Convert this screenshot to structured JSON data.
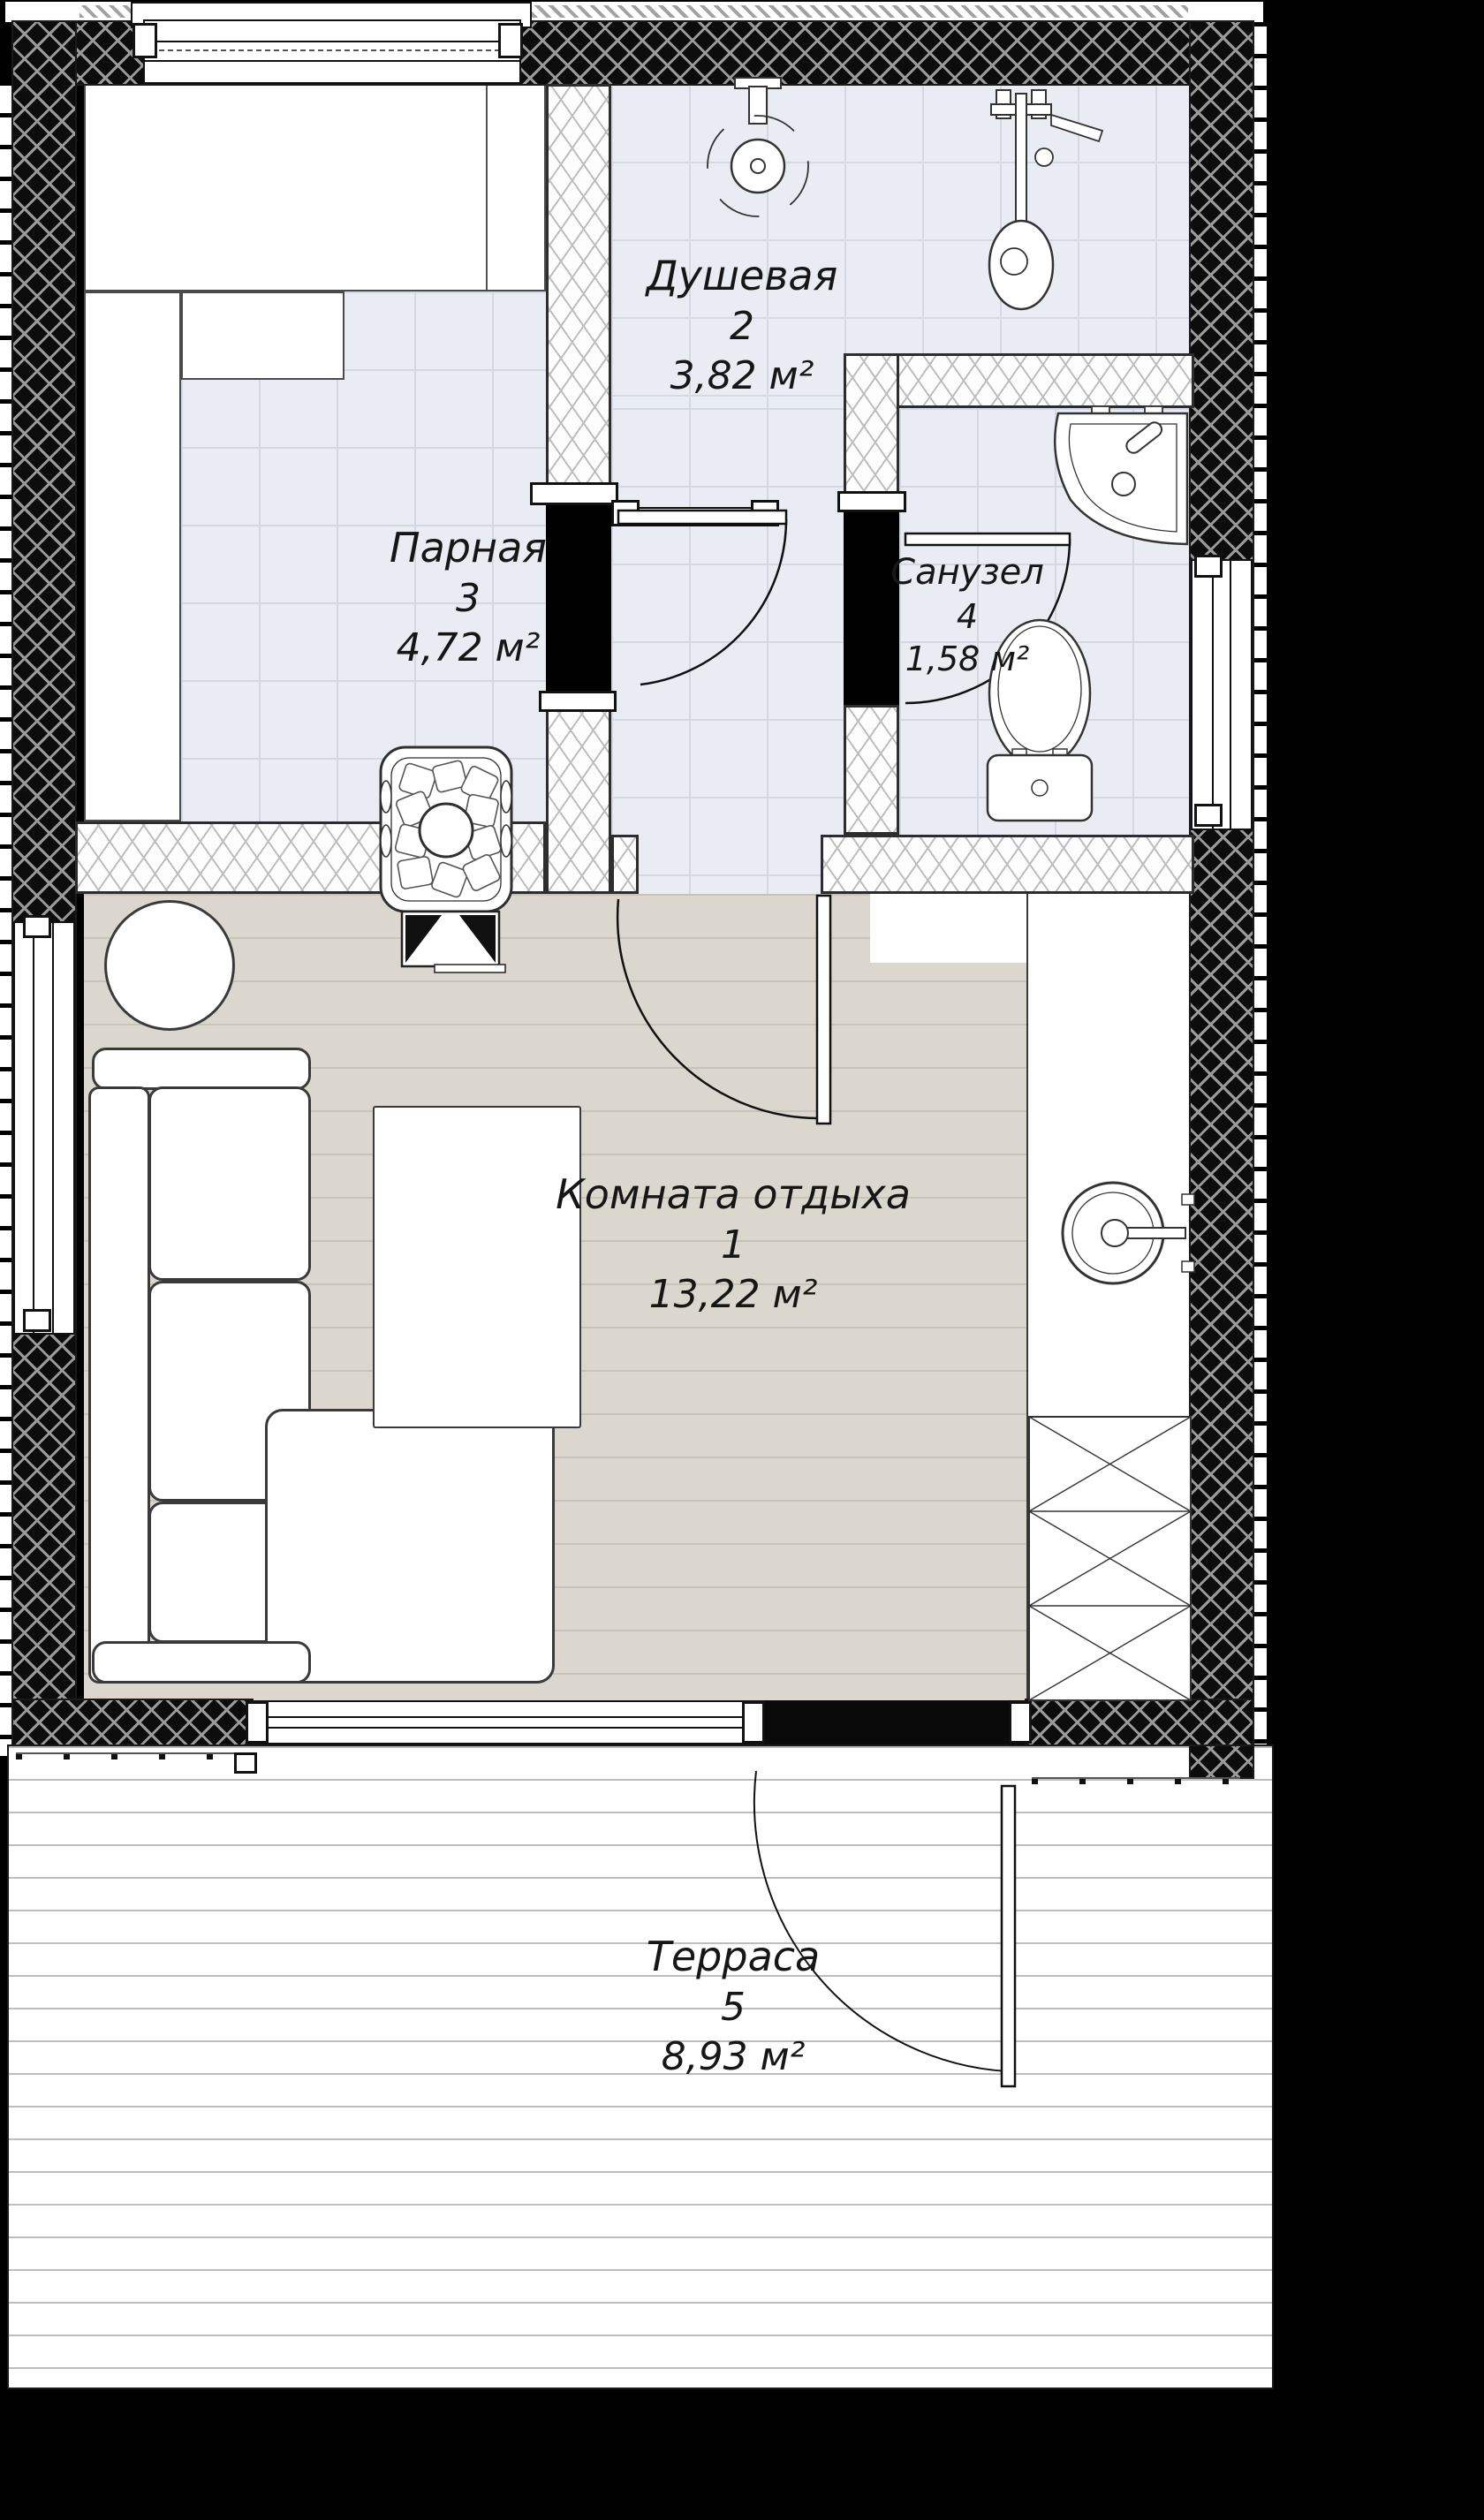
{
  "plan": {
    "type": "sauna-floor-plan",
    "units": "м²",
    "rooms": [
      {
        "name": "Комната отдыха",
        "number": "1",
        "area": "13,22 м²"
      },
      {
        "name": "Душевая",
        "number": "2",
        "area": "3,82 м²"
      },
      {
        "name": "Парная",
        "number": "3",
        "area": "4,72 м²"
      },
      {
        "name": "Санузел",
        "number": "4",
        "area": "1,58 м²"
      },
      {
        "name": "Терраса",
        "number": "5",
        "area": "8,93 м²"
      }
    ],
    "fixtures": [
      "sauna-stove",
      "ceiling-shower",
      "shower-column",
      "corner-sink",
      "toilet",
      "countertop-sink",
      "cabinet",
      "sofa",
      "round-table",
      "coffee-table"
    ],
    "colors": {
      "background": "#000000",
      "tile_floor": "#e9edf3",
      "wood_floor": "#dbd7ce",
      "deck_floor": "#ffffff",
      "wall_fill": "#0c0c0c",
      "line": "#1a1a1a"
    }
  }
}
